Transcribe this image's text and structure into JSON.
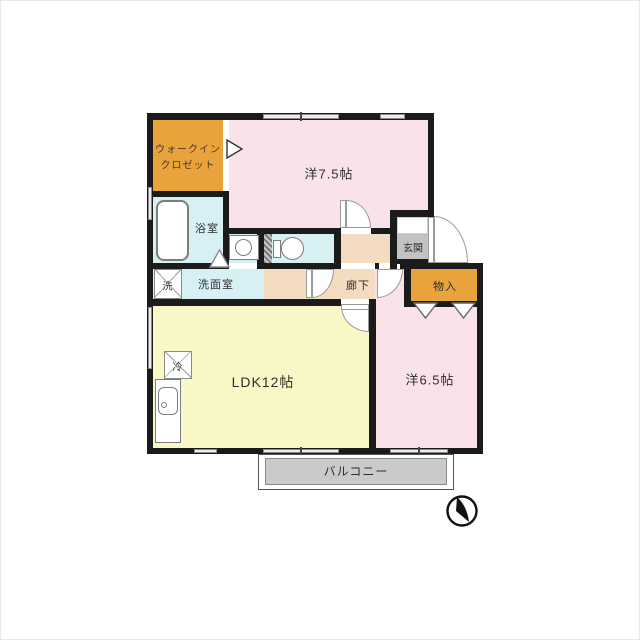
{
  "plan_title": "floor-plan",
  "rooms": {
    "walk_in_closet": {
      "label_line1": "ウォークイン",
      "label_line2": "クロゼット"
    },
    "western_room_7_5": {
      "label": "洋7.5帖"
    },
    "bathroom": {
      "label": "浴室"
    },
    "washroom": {
      "label": "洗面室"
    },
    "washer": {
      "label": "洗"
    },
    "corridor": {
      "label": "廊下"
    },
    "entrance": {
      "label": "玄関"
    },
    "storage": {
      "label": "物入"
    },
    "ldk": {
      "label": "LDK12帖"
    },
    "refrigerator": {
      "label": "冷"
    },
    "western_room_6_5": {
      "label": "洋6.5帖"
    },
    "balcony": {
      "label": "バルコニー"
    }
  },
  "colors": {
    "wall": "#1b1b1b",
    "room_pink": "#fae3e8",
    "room_yellow": "#faf7c6",
    "room_cyan": "#d7f0f4",
    "room_beige": "#f4dcc1",
    "closet_orange": "#e8a33c",
    "entrance_tile": "#c2c2c2",
    "balcony_gray": "#cacaca"
  },
  "icons": {
    "compass": "north-arrow"
  }
}
